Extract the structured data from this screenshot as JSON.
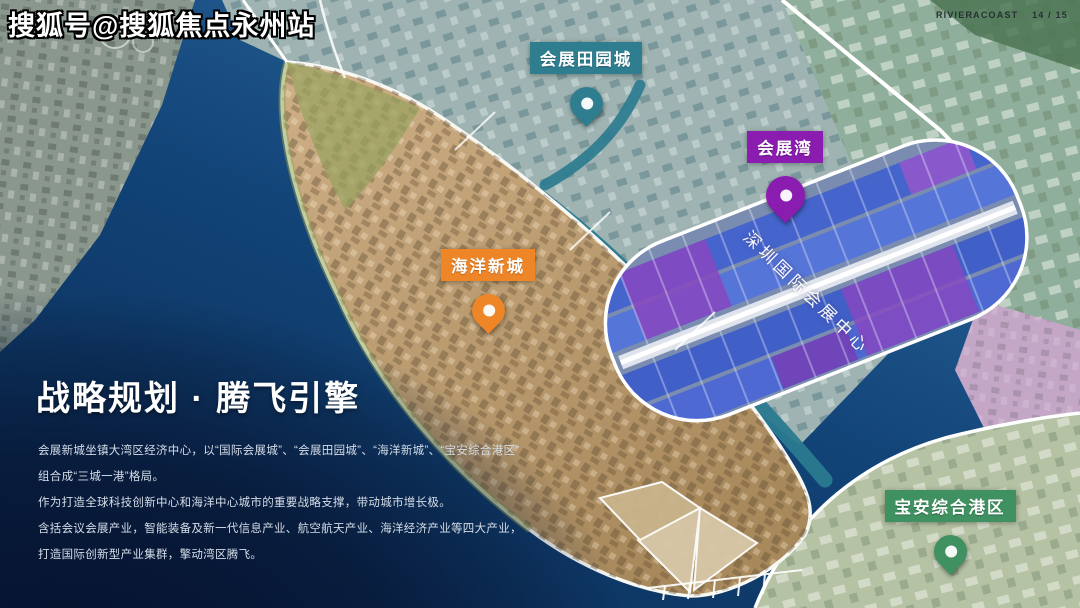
{
  "watermark": {
    "text": "搜狐号@搜狐焦点永州站"
  },
  "page_indicator": {
    "brand": "RIVIERACOAST",
    "page": "14 / 15"
  },
  "map": {
    "annotation": "深圳国际会展中心",
    "labels": [
      {
        "text": "会展田园城",
        "color": "#2e7e90"
      },
      {
        "text": "会展湾",
        "color": "#8a1caf"
      },
      {
        "text": "海洋新城",
        "color": "#ee8527"
      },
      {
        "text": "宝安综合港区",
        "color": "#3f9161"
      }
    ]
  },
  "panel": {
    "title": "战略规划 · 腾飞引擎",
    "lines": [
      "会展新城坐镇大湾区经济中心，以“国际会展城”、“会展田园城”、“海洋新城”、“宝安综合港区”",
      "组合成“三城一港”格局。",
      "作为打造全球科技创新中心和海洋中心城市的重要战略支撑，带动城市增长极。",
      "含括会议会展产业，智能装备及新一代信息产业、航空航天产业、海洋经济产业等四大产业，",
      "打造国际创新型产业集群，擎动湾区腾飞。"
    ]
  },
  "colors": {
    "sea_deep": "#092a52",
    "sea_light": "#2f6ba1",
    "island_gold": "#c9ab7d",
    "hall_blue": "#4565cd",
    "hall_purple": "#8a46c0",
    "outline_white": "#ffffff"
  }
}
